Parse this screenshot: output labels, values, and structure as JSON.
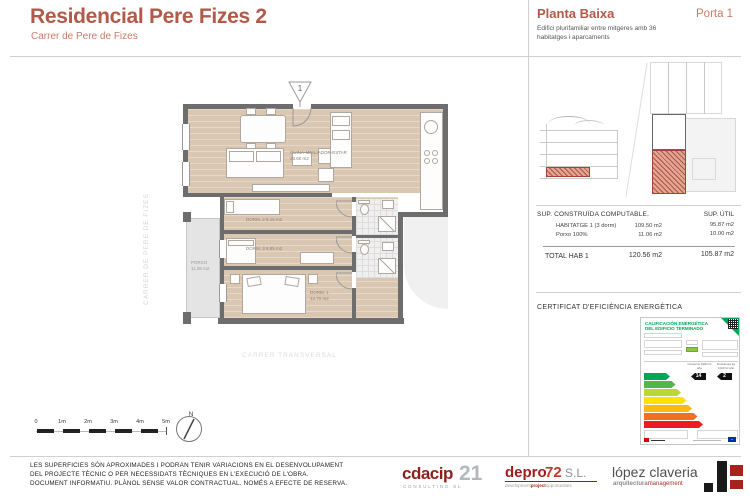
{
  "colors": {
    "accent": "#b2594a",
    "accent_light": "#c57b69",
    "wall": "#6d6d6d",
    "floor_tan": "#dac7b1",
    "energy_green": "#00a651"
  },
  "header": {
    "title": "Residencial Pere Fizes 2",
    "subtitle": "Carrer de Pere de Fizes"
  },
  "panel": {
    "plan_name": "Planta Baixa",
    "door_label": "Porta 1",
    "description_line1": "Edifici plurifamiliar entre mitgeres amb 36",
    "description_line2": "habitatges i aparcaments"
  },
  "surfaces": {
    "col_built_header": "SUP. CONSTRUÏDA COMPUTABLE.",
    "col_useful_header": "SUP. ÚTIL",
    "rows": [
      {
        "label": "HABITATGE 1  (3 dorm)",
        "built": "109.50 m2",
        "useful": "95.87 m2"
      },
      {
        "label": "Porxo 100%",
        "built": "11.06 m2",
        "useful": "10.00 m2"
      }
    ],
    "total": {
      "label": "TOTAL HAB 1",
      "built": "120.56 m2",
      "useful": "105.87 m2"
    }
  },
  "energy": {
    "section_title": "CERTIFICAT D'EFICIÈNCIA ENERGÈTICA",
    "card_title_line1": "CALIFICACIÓN ENERGÉTICA",
    "card_title_line2": "DEL EDIFICIO TERMINADO",
    "consumo_header": "Consumo kWh/m² año",
    "emisiones_header": "Emisiones kg CO2/m² año",
    "consumo_value": "14",
    "emisiones_value": "2",
    "ratings": [
      {
        "letter": "A",
        "color": "#00a651"
      },
      {
        "letter": "B",
        "color": "#50b848"
      },
      {
        "letter": "C",
        "color": "#bed630"
      },
      {
        "letter": "D",
        "color": "#ffe200"
      },
      {
        "letter": "E",
        "color": "#fdb913"
      },
      {
        "letter": "F",
        "color": "#f37021"
      },
      {
        "letter": "G",
        "color": "#ed1c24"
      }
    ]
  },
  "plan": {
    "street_left": "CARRER DE PERE DE FIZES",
    "street_bottom": "CARRER TRANSVERSAL",
    "entrance_marker": "1",
    "north_label": "N",
    "rooms": {
      "living_name": "CUINA-MENJADOR-ESTAR",
      "living_area": "33.60 m2",
      "dorm1_name": "DORM. 1",
      "dorm1_area": "12.70 m2",
      "dorm2_name": "DORM. 2",
      "dorm2_area": "9.15 m2",
      "dorm3_name": "DORM. 3",
      "dorm3_area": "8.85 m2",
      "porxo_name": "PORXO",
      "porxo_area": "11.06 m2"
    },
    "scale_labels": [
      "0",
      "1m",
      "2m",
      "3m",
      "4m",
      "5m"
    ]
  },
  "footer": {
    "disclaimer": [
      "LES SUPERFICIES SÓN APROXIMADES I PODRAN TENIR VARIACIONS EN EL DESENVOLUPAMENT",
      "DEL PROJECTE TÈCNIC O PER NECESSIDATS TÈCNIQUES EN L'EXECUCIÓ DE L'OBRA.",
      "DOCUMENT INFORMATIU. PLÀNOL SENSE VALOR CONTRACTUAL. NOMÉS A EFECTE DE RESERVA."
    ],
    "logos": {
      "cdacip_name": "cdacip",
      "cdacip_number": "21",
      "cdacip_sub": "CONSULTING SL",
      "depro_name": "depro",
      "depro_number": "72",
      "depro_suffix": "S.L.",
      "depro_sub1": "development",
      "depro_sub2": "project",
      "depro_sub3": "opportunities",
      "lopez_name": "lópez claveria",
      "lopez_sub1": "arquitectura",
      "lopez_sub2": "management"
    }
  }
}
